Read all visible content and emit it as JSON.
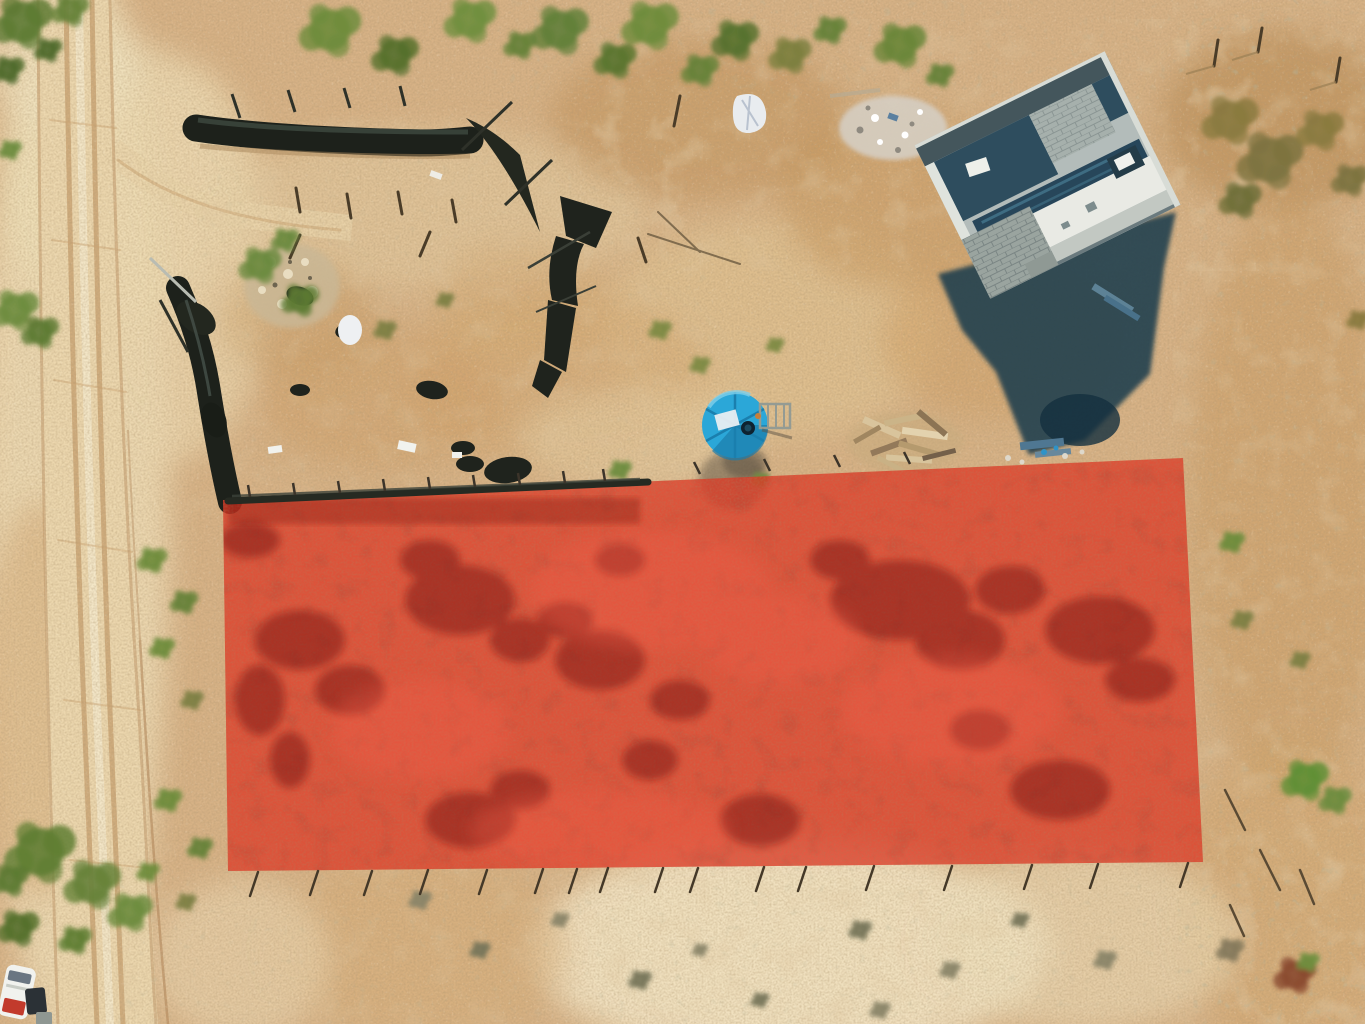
{
  "meta": {
    "title": "Aerial drone photo of a desert land parcel with highlighted lot boundary"
  },
  "scene": {
    "type": "aerial-drone-photograph",
    "description": "Top-down drone photo of a dry desert property: a dirt road runs along the left edge, a concrete house under construction with a large shadow sits at the upper right, a round blue water tank and black shade-cloth fences mark a fenced work area, and a semi-transparent red rectangle overlay highlights the lot for sale in the lower half.",
    "elements": [
      "dirt-road",
      "tire-tracks",
      "top-tarp-fence",
      "left-tarp-fence",
      "fallen-tarp-debris",
      "garden-rock-patch",
      "white-sacks",
      "rubble-pile",
      "construction-house",
      "house-shadow",
      "blue-water-tank",
      "tank-ladder",
      "lumber-pile",
      "highlighted-lot-overlay",
      "boundary-fence-line",
      "boundary-fence-posts",
      "desert-vegetation",
      "parked-vehicle"
    ]
  },
  "overlay": {
    "name": "highlighted-lot-boundary",
    "points_str": "223,500 1183,458 1203,862 228,871",
    "color": "#de3825",
    "opacity": "0.78"
  },
  "palette": {
    "ground": "#d7b286",
    "ground-light": "#eed9ae",
    "ground-pale": "#f5ead0",
    "ground-dark": "#c29460",
    "gold": "#c89a62",
    "road": "#ecd7ae",
    "track": "#c8a171",
    "veg-green": "#66823a",
    "veg-dark": "#4c6628",
    "veg-olive": "#7d7f44",
    "scrub-gray": "#85795c",
    "tarp": "#1d211b",
    "tarp-hi": "#49544a",
    "roof-white": "#e9eae4",
    "roof-gray": "#b3bcba",
    "wall-dark": "#44565c",
    "interior-dark": "#2e4d5e",
    "concrete": "#a6b0ac",
    "shadow": "#1e3d4d",
    "tank-blue": "#2ba7d8",
    "tank-dark": "#1c7cab",
    "wood": "#d9c49c",
    "wood-dark": "#93795a",
    "stick": "#493b28",
    "white": "#f1f2ee",
    "sack-white": "#e9ecef",
    "red-dark": "#72100a",
    "red-light": "#f4604b",
    "vehicle-red": "#c23a2c"
  }
}
